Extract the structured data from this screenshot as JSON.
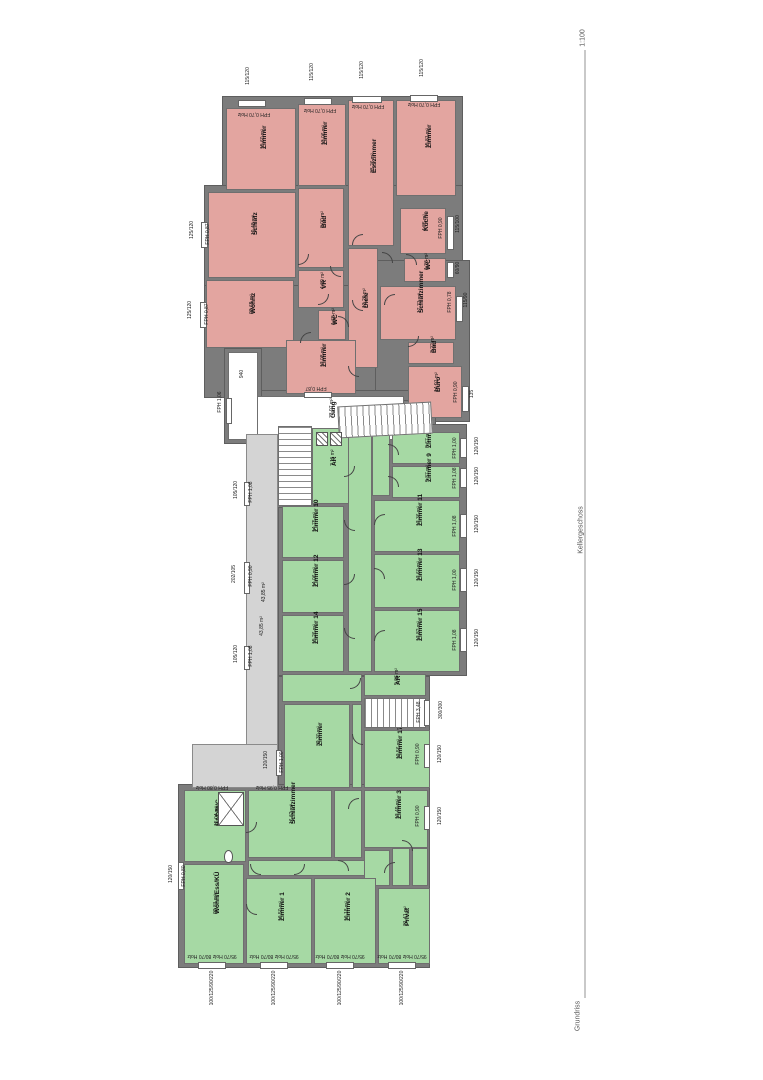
{
  "titleblock": {
    "scale": "1:100",
    "level": "Kellergeschoss",
    "caption": "Grundriss"
  },
  "colors": {
    "wall": "#7c7c7c",
    "red_room": "#e3a5a0",
    "green_room": "#a6d9a4",
    "void": "#d4d4d4",
    "paper": "#ffffff"
  },
  "plan": {
    "bases": [
      [
        222,
        96,
        241,
        99
      ],
      [
        204,
        185,
        259,
        107
      ],
      [
        204,
        285,
        176,
        113
      ],
      [
        375,
        260,
        95,
        162
      ],
      [
        250,
        390,
        162,
        56
      ],
      [
        224,
        348,
        38,
        96
      ],
      [
        334,
        400,
        102,
        38
      ],
      [
        278,
        424,
        189,
        252
      ],
      [
        278,
        676,
        152,
        116
      ],
      [
        178,
        784,
        252,
        184
      ],
      [
        274,
        422,
        42,
        86
      ]
    ],
    "rooms": [
      {
        "n": "Zimmer",
        "a": "15,60 m²",
        "t": "red",
        "x": 226,
        "y": 108,
        "w": 70,
        "h": 82
      },
      {
        "n": "Zimmer",
        "a": "13,06 m²",
        "t": "red",
        "x": 298,
        "y": 104,
        "w": 48,
        "h": 82
      },
      {
        "n": "Esszimmer",
        "a": "33,26 m²",
        "t": "red",
        "x": 348,
        "y": 100,
        "w": 46,
        "h": 146
      },
      {
        "n": "Zimmer",
        "a": "15,81 m²",
        "t": "red",
        "x": 396,
        "y": 100,
        "w": 60,
        "h": 96
      },
      {
        "n": "Schlafz",
        "a": "19,48 m²",
        "t": "red",
        "x": 208,
        "y": 192,
        "w": 88,
        "h": 86
      },
      {
        "n": "Bad",
        "a": "8,00 m²",
        "t": "red",
        "x": 298,
        "y": 188,
        "w": 46,
        "h": 80
      },
      {
        "n": "Küche",
        "a": "4,85 m²",
        "t": "red",
        "x": 400,
        "y": 208,
        "w": 46,
        "h": 46
      },
      {
        "n": "WC",
        "a": "1,26 m²",
        "t": "red",
        "x": 404,
        "y": 258,
        "w": 42,
        "h": 24
      },
      {
        "n": "Wohnz",
        "a": "23,69 m²",
        "t": "red",
        "x": 206,
        "y": 280,
        "w": 88,
        "h": 68
      },
      {
        "n": "VR",
        "a": "4,69 m²",
        "t": "red",
        "x": 298,
        "y": 270,
        "w": 46,
        "h": 38
      },
      {
        "n": "WC",
        "a": "1,65 m²",
        "t": "red",
        "x": 318,
        "y": 310,
        "w": 28,
        "h": 30
      },
      {
        "n": "Diele",
        "a": "13,20 m²",
        "t": "red",
        "x": 348,
        "y": 248,
        "w": 30,
        "h": 120
      },
      {
        "n": "Schlafzimmer",
        "a": "17,71 m²",
        "t": "red",
        "x": 380,
        "y": 286,
        "w": 76,
        "h": 54
      },
      {
        "n": "Bad",
        "a": "3,22 m²",
        "t": "red",
        "x": 408,
        "y": 342,
        "w": 46,
        "h": 22
      },
      {
        "n": "Zimmer",
        "a": "17,08 m²",
        "t": "red",
        "x": 286,
        "y": 340,
        "w": 70,
        "h": 54
      },
      {
        "n": "Büro",
        "a": "14,91 m²",
        "t": "red",
        "x": 408,
        "y": 366,
        "w": 54,
        "h": 52
      },
      {
        "n": "Gang",
        "a": "73,97 m²",
        "t": "white",
        "x": 256,
        "y": 396,
        "w": 148,
        "h": 44
      },
      {
        "n": "",
        "a": "",
        "t": "white",
        "x": 228,
        "y": 352,
        "w": 30,
        "h": 88
      },
      {
        "n": "AR",
        "a": "7,11 m²",
        "t": "green",
        "x": 312,
        "y": 428,
        "w": 38,
        "h": 76
      },
      {
        "n": "",
        "a": "",
        "t": "green",
        "x": 348,
        "y": 430,
        "w": 24,
        "h": 242
      },
      {
        "n": "",
        "a": "",
        "t": "green",
        "x": 372,
        "y": 432,
        "w": 18,
        "h": 64
      },
      {
        "n": "Zimmer 7",
        "a": "8,67 m²",
        "t": "green",
        "x": 392,
        "y": 432,
        "w": 68,
        "h": 32
      },
      {
        "n": "Zimmer 9",
        "a": "9,37 m²",
        "t": "green",
        "x": 392,
        "y": 466,
        "w": 68,
        "h": 32
      },
      {
        "n": "Zimmer 11",
        "a": "17,36 m²",
        "t": "green",
        "x": 374,
        "y": 500,
        "w": 86,
        "h": 52
      },
      {
        "n": "Zimmer 13",
        "a": "17,60 m²",
        "t": "green",
        "x": 374,
        "y": 554,
        "w": 86,
        "h": 54
      },
      {
        "n": "Zimmer 15",
        "a": "17,82 m²",
        "t": "green",
        "x": 374,
        "y": 610,
        "w": 86,
        "h": 62
      },
      {
        "n": "Zimmer 10",
        "a": "14,75 m²",
        "t": "green",
        "x": 282,
        "y": 506,
        "w": 62,
        "h": 52
      },
      {
        "n": "Zimmer 12",
        "a": "14,06 m²",
        "t": "green",
        "x": 282,
        "y": 560,
        "w": 62,
        "h": 53
      },
      {
        "n": "Zimmer 14",
        "a": "15,26 m²",
        "t": "green",
        "x": 282,
        "y": 615,
        "w": 62,
        "h": 57
      },
      {
        "n": "",
        "a": "",
        "t": "green",
        "x": 282,
        "y": 674,
        "w": 80,
        "h": 28
      },
      {
        "n": "AR",
        "a": "5,06 m²",
        "t": "green",
        "x": 364,
        "y": 674,
        "w": 62,
        "h": 22
      },
      {
        "n": "",
        "a": "",
        "t": "white",
        "x": 364,
        "y": 698,
        "w": 62,
        "h": 30
      },
      {
        "n": "Zimmer",
        "a": "32,30 m²",
        "t": "green",
        "x": 284,
        "y": 704,
        "w": 66,
        "h": 84
      },
      {
        "n": "",
        "a": "",
        "t": "green",
        "x": 352,
        "y": 704,
        "w": 10,
        "h": 84
      },
      {
        "n": "Zimmer 17",
        "a": "12,56 m²",
        "t": "green",
        "x": 364,
        "y": 730,
        "w": 66,
        "h": 58
      },
      {
        "n": "BAD/WC",
        "a": "15,04 m²",
        "t": "green",
        "x": 184,
        "y": 790,
        "w": 62,
        "h": 72
      },
      {
        "n": "Schlafzimmer",
        "a": "16,62 m²",
        "t": "green",
        "x": 248,
        "y": 790,
        "w": 84,
        "h": 68
      },
      {
        "n": "",
        "a": "",
        "t": "green",
        "x": 334,
        "y": 790,
        "w": 28,
        "h": 68
      },
      {
        "n": "Zimmer 3",
        "a": "17,49 m²",
        "t": "green",
        "x": 364,
        "y": 790,
        "w": 64,
        "h": 58
      },
      {
        "n": "",
        "a": "",
        "t": "green",
        "x": 248,
        "y": 860,
        "w": 142,
        "h": 16
      },
      {
        "n": "",
        "a": "",
        "t": "green",
        "x": 392,
        "y": 848,
        "w": 18,
        "h": 38
      },
      {
        "n": "",
        "a": "",
        "t": "green",
        "x": 412,
        "y": 848,
        "w": 16,
        "h": 38
      },
      {
        "n": "",
        "a": "",
        "t": "green",
        "x": 364,
        "y": 850,
        "w": 26,
        "h": 36
      },
      {
        "n": "Wohn/Ess/KÜ",
        "a": "22,81 m²",
        "t": "green",
        "x": 184,
        "y": 864,
        "w": 60,
        "h": 100
      },
      {
        "n": "Zimmer 1",
        "a": "16,50 m²",
        "t": "green",
        "x": 246,
        "y": 878,
        "w": 66,
        "h": 86
      },
      {
        "n": "Zimmer 2",
        "a": "16,18 m²",
        "t": "green",
        "x": 314,
        "y": 878,
        "w": 62,
        "h": 86
      },
      {
        "n": "Privat",
        "a": "21,41 m²",
        "t": "green",
        "x": 378,
        "y": 888,
        "w": 52,
        "h": 76
      },
      {
        "n": "",
        "a": "43,85 m²",
        "t": "void",
        "x": 246,
        "y": 434,
        "w": 32,
        "h": 336
      },
      {
        "n": "",
        "a": "",
        "t": "void",
        "x": 192,
        "y": 744,
        "w": 86,
        "h": 44
      }
    ],
    "stairs": [
      [
        278,
        426,
        34,
        80,
        "v",
        0
      ],
      [
        364,
        698,
        62,
        30,
        "h",
        0
      ],
      [
        338,
        404,
        94,
        32,
        "h",
        -3
      ]
    ],
    "windows": [
      [
        238,
        100,
        28,
        7
      ],
      [
        304,
        98,
        28,
        7
      ],
      [
        352,
        96,
        30,
        7
      ],
      [
        410,
        95,
        28,
        7
      ],
      [
        201,
        222,
        7,
        26
      ],
      [
        200,
        302,
        7,
        26
      ],
      [
        447,
        216,
        7,
        34
      ],
      [
        447,
        262,
        7,
        16
      ],
      [
        456,
        296,
        7,
        26
      ],
      [
        462,
        386,
        7,
        26
      ],
      [
        304,
        392,
        28,
        6
      ],
      [
        226,
        398,
        6,
        26
      ],
      [
        460,
        438,
        7,
        20
      ],
      [
        460,
        468,
        7,
        20
      ],
      [
        460,
        514,
        7,
        24
      ],
      [
        460,
        568,
        7,
        24
      ],
      [
        460,
        628,
        7,
        24
      ],
      [
        424,
        700,
        6,
        26
      ],
      [
        424,
        744,
        6,
        24
      ],
      [
        424,
        806,
        6,
        24
      ],
      [
        244,
        482,
        6,
        24
      ],
      [
        244,
        562,
        6,
        32
      ],
      [
        244,
        646,
        6,
        24
      ],
      [
        276,
        750,
        6,
        26
      ],
      [
        198,
        962,
        28,
        7
      ],
      [
        260,
        962,
        28,
        7
      ],
      [
        326,
        962,
        28,
        7
      ],
      [
        388,
        962,
        28,
        7
      ],
      [
        178,
        862,
        6,
        28
      ]
    ],
    "doors": [
      [
        298,
        254,
        0
      ],
      [
        330,
        266,
        90
      ],
      [
        352,
        234,
        180
      ],
      [
        382,
        252,
        270
      ],
      [
        318,
        294,
        0
      ],
      [
        352,
        300,
        90
      ],
      [
        384,
        294,
        180
      ],
      [
        338,
        316,
        270
      ],
      [
        408,
        336,
        0
      ],
      [
        348,
        366,
        90
      ],
      [
        300,
        332,
        180
      ],
      [
        406,
        254,
        270
      ],
      [
        344,
        466,
        0
      ],
      [
        344,
        520,
        90
      ],
      [
        344,
        574,
        0
      ],
      [
        344,
        628,
        90
      ],
      [
        374,
        514,
        180
      ],
      [
        374,
        568,
        270
      ],
      [
        374,
        630,
        180
      ],
      [
        388,
        444,
        270
      ],
      [
        388,
        476,
        270
      ],
      [
        350,
        678,
        0
      ],
      [
        352,
        734,
        90
      ],
      [
        348,
        798,
        180
      ],
      [
        338,
        860,
        270
      ],
      [
        294,
        864,
        0
      ],
      [
        250,
        864,
        90
      ],
      [
        384,
        862,
        180
      ],
      [
        402,
        840,
        270
      ],
      [
        246,
        822,
        0
      ],
      [
        246,
        904,
        90
      ]
    ],
    "fixtures": [
      {
        "t": "hatch",
        "x": 316,
        "y": 432,
        "w": 12,
        "h": 14
      },
      {
        "t": "hatch",
        "x": 330,
        "y": 432,
        "w": 12,
        "h": 14
      },
      {
        "t": "shower",
        "x": 218,
        "y": 792,
        "w": 26,
        "h": 34
      },
      {
        "t": "toilet",
        "x": 224,
        "y": 850,
        "w": 9,
        "h": 13
      }
    ],
    "annotations": [
      [
        "115/120",
        248,
        76,
        -90
      ],
      [
        "115/120",
        312,
        72,
        -90
      ],
      [
        "115/120",
        362,
        70,
        -90
      ],
      [
        "115/120",
        422,
        68,
        -90
      ],
      [
        "FPH 0,70 Holz",
        254,
        114,
        180
      ],
      [
        "FPH 0,70 Holz",
        320,
        110,
        180
      ],
      [
        "FPH 0,70 Holz",
        368,
        106,
        180
      ],
      [
        "FPH 0,70 Holz",
        424,
        104,
        180
      ],
      [
        "FPH 0,87",
        208,
        234,
        -90
      ],
      [
        "125/120",
        192,
        230,
        -90
      ],
      [
        "FPH 0,87",
        207,
        314,
        -90
      ],
      [
        "125/120",
        190,
        310,
        -90
      ],
      [
        "FPH 0,90",
        441,
        228,
        -90
      ],
      [
        "115/100",
        458,
        224,
        -90
      ],
      [
        "60/90",
        458,
        268,
        -90
      ],
      [
        "FPH 0,78",
        450,
        302,
        -90
      ],
      [
        "115/90",
        466,
        300,
        -90
      ],
      [
        "FPH 0,90",
        456,
        392,
        -90
      ],
      [
        "135",
        472,
        394,
        -90
      ],
      [
        "940",
        242,
        374,
        -90
      ],
      [
        "FPH 1,06",
        220,
        402,
        -90
      ],
      [
        "FPH 0,87",
        316,
        388,
        180
      ],
      [
        "FPH 1,00",
        455,
        448,
        -90
      ],
      [
        "FPH 1,08",
        455,
        478,
        -90
      ],
      [
        "FPH 1,08",
        455,
        526,
        -90
      ],
      [
        "FPH 1,00",
        455,
        580,
        -90
      ],
      [
        "FPH 1,08",
        455,
        640,
        -90
      ],
      [
        "120/150",
        477,
        446,
        -90
      ],
      [
        "120/150",
        477,
        476,
        -90
      ],
      [
        "120/150",
        477,
        524,
        -90
      ],
      [
        "120/150",
        477,
        578,
        -90
      ],
      [
        "120/150",
        477,
        638,
        -90
      ],
      [
        "FPH 3,48",
        419,
        712,
        -90
      ],
      [
        "300/300",
        441,
        710,
        -90
      ],
      [
        "FPH 0,90",
        418,
        754,
        -90
      ],
      [
        "120/150",
        440,
        754,
        -90
      ],
      [
        "FPH 0,90",
        418,
        816,
        -90
      ],
      [
        "120/150",
        440,
        816,
        -90
      ],
      [
        "FPH 1,08",
        251,
        492,
        -90
      ],
      [
        "105/120",
        236,
        490,
        -90
      ],
      [
        "FPH 0,90",
        251,
        576,
        -90
      ],
      [
        "202/105",
        234,
        574,
        -90
      ],
      [
        "FPH 1,08",
        251,
        656,
        -90
      ],
      [
        "105/120",
        236,
        654,
        -90
      ],
      [
        "43,85 m²",
        262,
        626,
        -90
      ],
      [
        "FPH 1,00",
        282,
        762,
        -90
      ],
      [
        "120/150",
        266,
        760,
        -90
      ],
      [
        "FPH 0,80 Holz",
        212,
        787,
        180
      ],
      [
        "FPH 0,95 Holz",
        272,
        787,
        180
      ],
      [
        "FPH 0,80",
        184,
        876,
        -90
      ],
      [
        "120/150",
        171,
        874,
        -90
      ],
      [
        "95/70 Holz 80/70 Holz",
        212,
        956,
        180
      ],
      [
        "95/70 Holz 80/70 Holz",
        274,
        956,
        180
      ],
      [
        "95/70 Holz 80/70 Holz",
        340,
        956,
        180
      ],
      [
        "95/70 Holz 80/70 Holz",
        402,
        956,
        180
      ],
      [
        "100/125/90/220",
        212,
        988,
        -90
      ],
      [
        "100/125/90/220",
        274,
        988,
        -90
      ],
      [
        "100/125/90/220",
        340,
        988,
        -90
      ],
      [
        "100/125/90/220",
        402,
        988,
        -90
      ]
    ]
  }
}
